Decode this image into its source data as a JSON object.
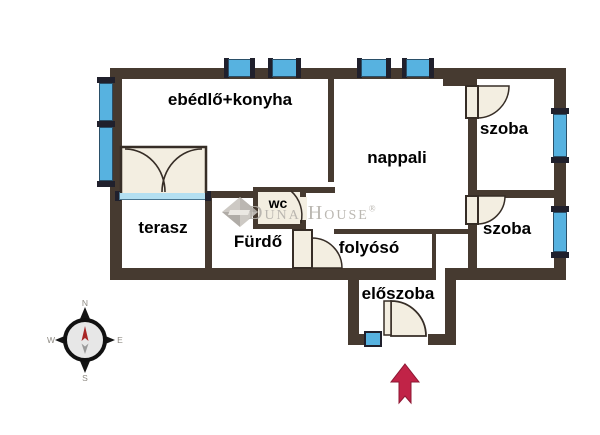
{
  "type": "apartment-floor-plan",
  "language": "hu",
  "rooms": {
    "ebedlo_konyha": {
      "label": "ebédlő+konyha"
    },
    "nappali": {
      "label": "nappali"
    },
    "szoba_felso": {
      "label": "szoba"
    },
    "szoba_also": {
      "label": "szoba"
    },
    "terasz": {
      "label": "terasz"
    },
    "furdo": {
      "label": "Fürdő"
    },
    "wc": {
      "label": "wc"
    },
    "folyoso": {
      "label": "folyósó"
    },
    "eloszoba": {
      "label": "előszoba"
    }
  },
  "watermark": {
    "text": "Duna House",
    "reg": "®"
  },
  "compass": {
    "n": "N",
    "e": "E",
    "s": "S",
    "w": "W"
  },
  "colors": {
    "wall": "#463a30",
    "window": "#57b2e0",
    "window_cap": "#20202c",
    "sill": "#b3dff1",
    "door_fill": "#f3eee1",
    "door_stroke": "#362d26",
    "label": "#000000",
    "watermark": "#b6b2ac",
    "arrow_red": "#c12347",
    "compass_red": "#a82626"
  }
}
